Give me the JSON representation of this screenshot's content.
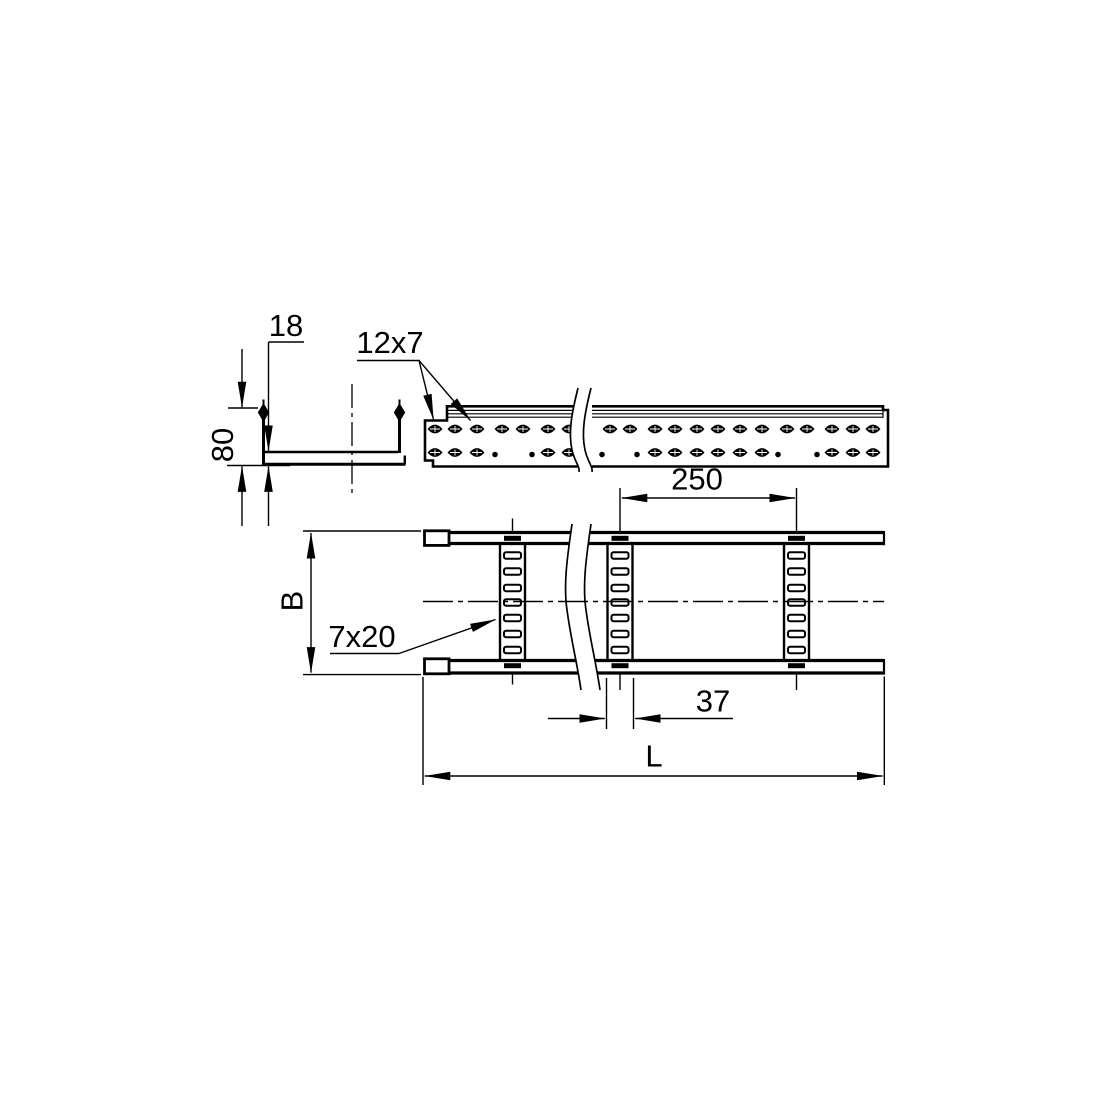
{
  "drawing_title": "cable-ladder-technical-drawing",
  "colors": {
    "background": "#ffffff",
    "line": "#000000"
  },
  "cross_section": {
    "dim_flange": "18",
    "dim_height": "80"
  },
  "side_view": {
    "label_holes": "12x7",
    "perforation": {
      "top_row_y": 429,
      "bottom_row_y": 452.5,
      "left_top_slots_x": [
        435,
        455,
        477,
        502,
        523,
        548,
        569
      ],
      "left_bottom_slots_x": [
        435,
        455,
        477,
        548,
        569
      ],
      "left_bottom_dots_x": [
        495,
        532
      ],
      "right_top_slots_x": [
        610,
        630,
        655,
        675,
        697,
        718,
        740,
        762,
        787,
        807,
        832,
        853,
        873
      ],
      "right_bottom_slots_x": [
        655,
        675,
        697,
        718,
        740,
        762,
        832,
        853,
        873
      ],
      "right_bottom_dots_x": [
        602,
        637,
        778,
        817
      ]
    }
  },
  "plan_view": {
    "dim_pitch": "250",
    "dim_width": "B",
    "label_rung_holes": "7x20",
    "dim_rung_width": "37",
    "dim_length": "L",
    "rungs": {
      "centers_x": [
        512.5,
        620,
        796.5
      ],
      "half_width": 12.5,
      "slot_centers_y": [
        555.5,
        571.5,
        588,
        602.5,
        618,
        634,
        650
      ],
      "center_line_top_y": [
        518.5,
        488,
        488
      ],
      "center_line_bottom_y": [
        684.5,
        690,
        690
      ]
    }
  }
}
